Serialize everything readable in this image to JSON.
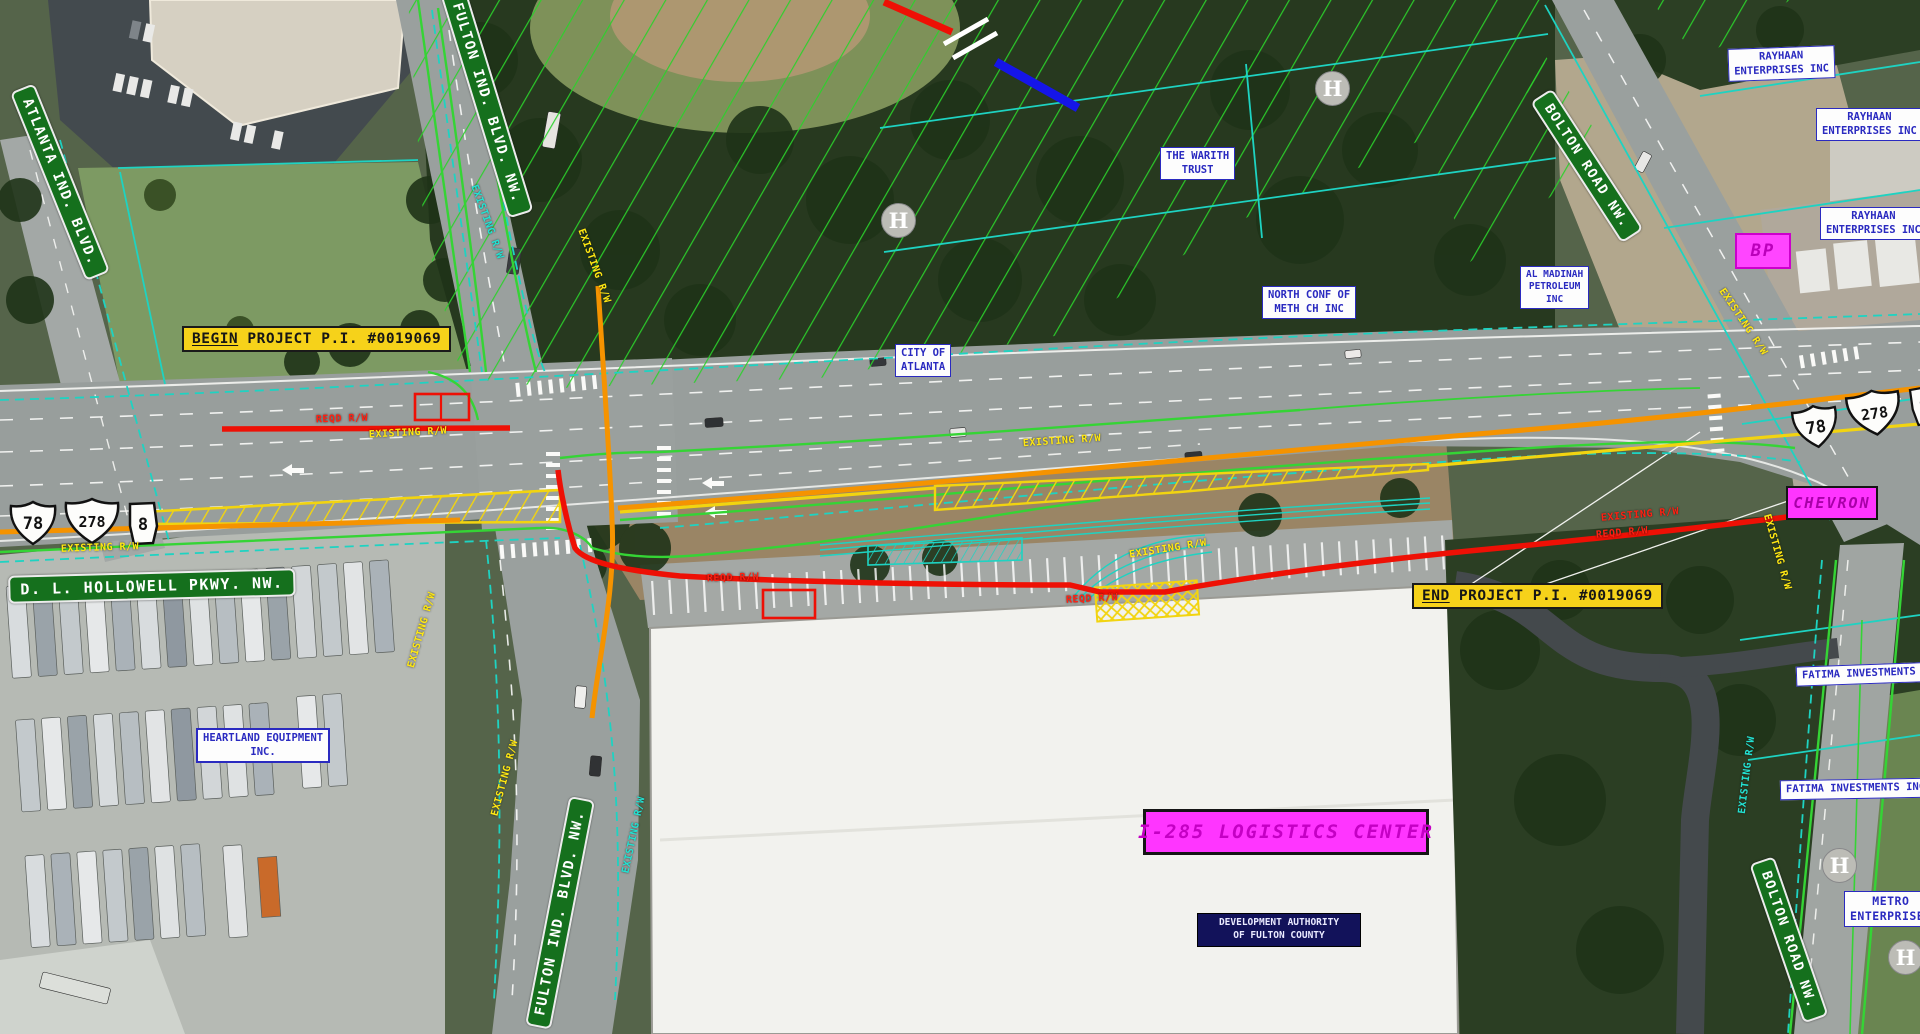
{
  "project": {
    "begin_word": "BEGIN",
    "begin_rest": " PROJECT P.I. #0019069",
    "end_word": "END",
    "end_rest": " PROJECT P.I. #0019069"
  },
  "street_signs": {
    "atlanta_ind_blvd": "ATLANTA IND. BLVD.",
    "fulton_ind_blvd_top": "FULTON IND. BLVD. NW.",
    "fulton_ind_blvd_bottom": "FULTON IND. BLVD. NW.",
    "hollowell": "D. L. HOLLOWELL PKWY. NW.",
    "bolton_top": "BOLTON ROAD NW.",
    "bolton_bottom": "BOLTON ROAD NW."
  },
  "route_shields": {
    "left": [
      "78",
      "278",
      "8"
    ],
    "right": [
      "78",
      "278",
      "8"
    ]
  },
  "parcels": {
    "warith": [
      "THE WARITH",
      "TRUST"
    ],
    "north_conf": [
      "NORTH CONF OF",
      "METH CH INC"
    ],
    "city_of_atlanta": [
      "CITY OF",
      "ATLANTA"
    ],
    "rayhaan": [
      "RAYHAAN",
      "ENTERPRISES INC"
    ],
    "al_madinah": [
      "AL MADINAH",
      "PETROLEUM",
      "INC"
    ],
    "fatima": "FATIMA INVESTMENTS INC",
    "heartland": [
      "HEARTLAND EQUIPMENT",
      "INC."
    ],
    "metro": [
      "METRO",
      "ENTERPRISES"
    ]
  },
  "landmarks": {
    "logistics_center": "I-285 LOGISTICS CENTER",
    "dev_authority": [
      "DEVELOPMENT AUTHORITY",
      "OF FULTON COUNTY"
    ],
    "bp": "BP",
    "chevron": "CHEVRON"
  },
  "rw_labels": {
    "existing": "EXISTING R/W",
    "required": "REQD R/W"
  },
  "symbols": {
    "hydrant_h": "H"
  },
  "colors": {
    "parcel_hatch_green": "#2bd12b",
    "existing_rw_teal": "#1ed3c2",
    "proposed_orange": "#f59300",
    "proposed_yellow": "#f2d410",
    "required_rw_red": "#ee1005",
    "match_blue": "#1515e8",
    "construction_green": "#35d435",
    "sign_green": "#15701d",
    "label_blue": "#2a2ac0",
    "highlight_magenta": "#ff35ff",
    "project_box_yellow": "#f6d21a"
  }
}
